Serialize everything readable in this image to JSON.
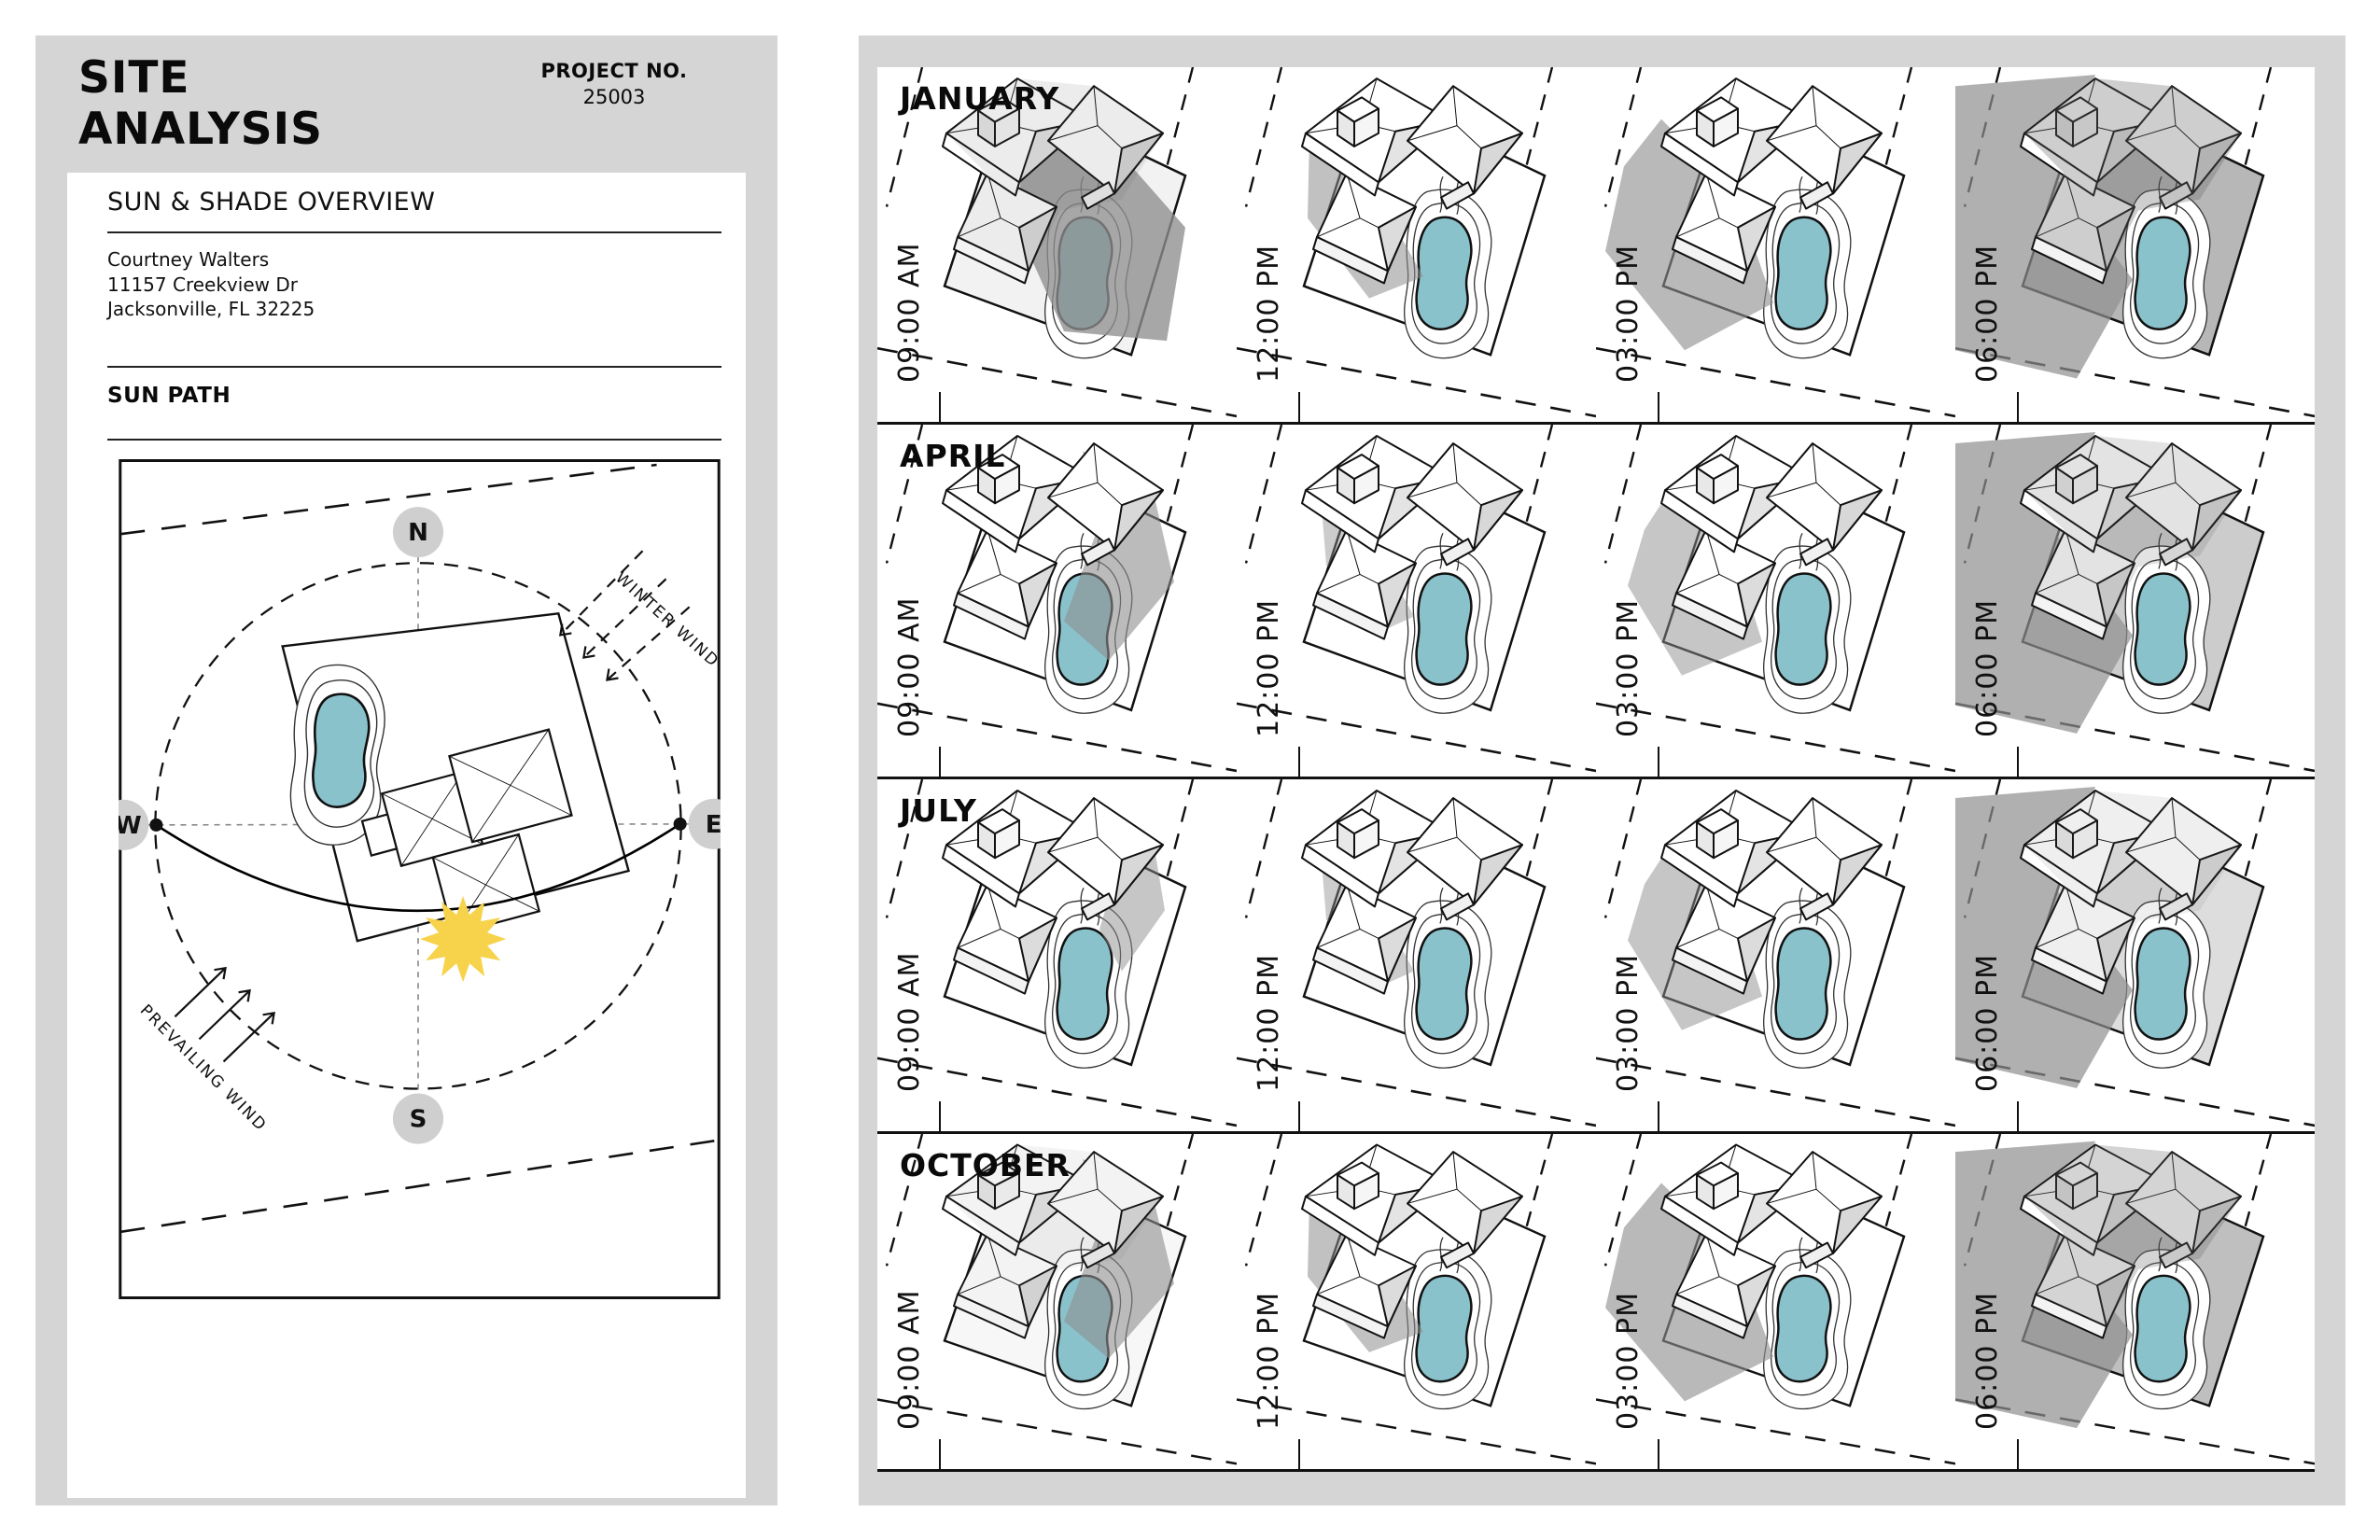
{
  "page": {
    "sheet_gray": "#d5d5d5",
    "pool_color": "#8ac2cc",
    "sun_color": "#f6d34a",
    "shadow_gray": "#8e8e8e"
  },
  "left_panel": {
    "title_line1": "SITE",
    "title_line2": "ANALYSIS",
    "project_label": "PROJECT NO.",
    "project_number": "25003",
    "overview_title": "SUN & SHADE OVERVIEW",
    "client_name": "Courtney Walters",
    "client_address_line1": "11157 Creekview Dr",
    "client_address_line2": "Jacksonville, FL 32225",
    "section_title": "SUN PATH",
    "compass": {
      "n": "N",
      "e": "E",
      "s": "S",
      "w": "W"
    },
    "winter_wind_label": "WINTER WIND",
    "prevailing_wind_label": "PREVAILING WIND"
  },
  "study_grid": {
    "months": [
      {
        "label": "JANUARY",
        "cells": [
          {
            "time": "09:00 AM",
            "shadow": "long-se",
            "dim": 0.12,
            "plot": "#f2f2f2"
          },
          {
            "time": "12:00 PM",
            "shadow": "med-sw",
            "dim": 0,
            "plot": "#ffffff"
          },
          {
            "time": "03:00 PM",
            "shadow": "long-w",
            "dim": 0,
            "plot": "#ffffff"
          },
          {
            "time": "06:00 PM",
            "shadow": "huge-w",
            "dim": 0.32,
            "plot": "#b7b7b7"
          }
        ]
      },
      {
        "label": "APRIL",
        "cells": [
          {
            "time": "09:00 AM",
            "shadow": "med-se",
            "dim": 0,
            "plot": "#ffffff"
          },
          {
            "time": "12:00 PM",
            "shadow": "short-sw",
            "dim": 0,
            "plot": "#ffffff"
          },
          {
            "time": "03:00 PM",
            "shadow": "med-w",
            "dim": 0,
            "plot": "#ffffff"
          },
          {
            "time": "06:00 PM",
            "shadow": "huge-w",
            "dim": 0.18,
            "plot": "#cccccc"
          }
        ]
      },
      {
        "label": "JULY",
        "cells": [
          {
            "time": "09:00 AM",
            "shadow": "short-se",
            "dim": 0,
            "plot": "#ffffff"
          },
          {
            "time": "12:00 PM",
            "shadow": "short-sw",
            "dim": 0,
            "plot": "#ffffff"
          },
          {
            "time": "03:00 PM",
            "shadow": "med-w",
            "dim": 0,
            "plot": "#ffffff"
          },
          {
            "time": "06:00 PM",
            "shadow": "huge-w",
            "dim": 0.1,
            "plot": "#dddddd"
          }
        ]
      },
      {
        "label": "OCTOBER",
        "cells": [
          {
            "time": "09:00 AM",
            "shadow": "med-se",
            "dim": 0.08,
            "plot": "#f7f7f7"
          },
          {
            "time": "12:00 PM",
            "shadow": "med-sw",
            "dim": 0,
            "plot": "#ffffff"
          },
          {
            "time": "03:00 PM",
            "shadow": "long-w",
            "dim": 0,
            "plot": "#ffffff"
          },
          {
            "time": "06:00 PM",
            "shadow": "huge-w",
            "dim": 0.28,
            "plot": "#bfbfbf"
          }
        ]
      }
    ]
  }
}
